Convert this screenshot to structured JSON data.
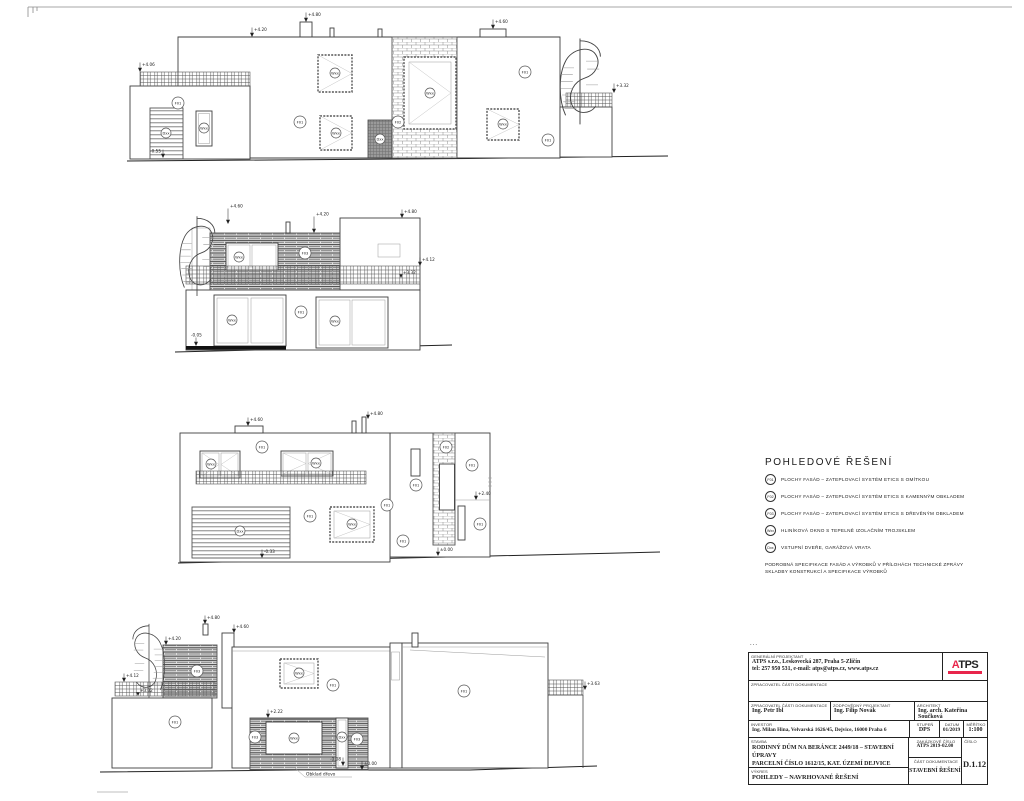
{
  "labels": {
    "f01": "F01",
    "f02": "F02",
    "f03": "F03",
    "w": "Wxx",
    "d": "Dxx"
  },
  "marks": {
    "e1": {
      "p406": "+4.06",
      "p420": "+4.20",
      "p480": "+4.80",
      "p460": "+4.60",
      "p332": "+3.32",
      "n055": "-0.55"
    },
    "e2": {
      "p460": "+4.60",
      "p420": "+4.20",
      "p480": "+4.80",
      "p412": "+4.12",
      "p332": "+3.32",
      "n005": "-0.05"
    },
    "e3": {
      "p460": "+4.60",
      "p480": "+4.80",
      "n033": "-0.33",
      "p240": "+2.40",
      "z000": "±0.00"
    },
    "e4": {
      "p412": "+4.12",
      "p332": "+3.32",
      "p420": "+4.20",
      "p480": "+4.80",
      "p460": "+4.60",
      "p222": "+2.22",
      "n008": "-0.08",
      "z000": "±0.00",
      "p363": "+3.63"
    }
  },
  "annotations": {
    "wood_cladding": "Obklad dřevo"
  },
  "legend": {
    "title": "POHLEDOVÉ ŘEŠENÍ",
    "items": [
      {
        "code": "F01",
        "text": "PLOCHY FASÁD – ZATEPLOVACÍ SYSTÉM ETICS S OMÍTKOU"
      },
      {
        "code": "F02",
        "text": "PLOCHY FASÁD – ZATEPLOVACÍ SYSTÉM ETICS S KAMENNÝM OBKLADEM"
      },
      {
        "code": "F03",
        "text": "PLOCHY FASÁD – ZATEPLOVACÍ SYSTÉM ETICS S DŘEVĚNÝM OBKLADEM"
      },
      {
        "code": "Wxx",
        "text": "HLINÍKOVÁ OKNO S TEPELNĚ IZOLAČNÍM TROJSKLEM"
      },
      {
        "code": "Dxx",
        "text": "VSTUPNÍ DVEŘE, GARÁŽOVÁ VRATA"
      }
    ],
    "note1": "PODROBNÁ SPECIFIKACE FASÁD A VÝROBKŮ V PŘÍLOHÁCH TECHNICKÉ ZPRÁVY",
    "note2": "SKLADBY KONSTRUKCÍ A SPECIFIKACE VÝROBKŮ"
  },
  "titleblock": {
    "dots": "...",
    "general_label": "GENERÁLNÍ PROJEKTANT",
    "company_line1": "ATPS s.r.o., Leskovecká 287, Praha 5-Zličín",
    "company_line2": "tel: 257 950 531, e-mail: atps@atps.cz, www.atps.cz",
    "logo_first_letter": "A",
    "logo_rest": "TPS",
    "processor_label": "ZPRACOVATEL ČÁSTI DOKUMENTACE",
    "processor_name": "Ing. Petr Ibl",
    "responsible_label": "ZODPOVĚDNÝ PROJEKTANT",
    "responsible_name": "Ing. Filip Novák",
    "architect_label": "ARCHITEKT",
    "architect_name": "Ing. arch. Kateřina Součková",
    "investor_label": "INVESTOR",
    "investor_name": "Ing. Milan Hina, Velvarská 1626/45, Dejvice, 16000 Praha 6",
    "stupen_label": "STUPEŇ",
    "stupen": "DPS",
    "datum_label": "DATUM",
    "datum": "01/2019",
    "meritko_label": "MĚŘÍTKO",
    "meritko": "1:100",
    "stavba_label": "STAVBA",
    "stavba_line1": "RODINNÝ DŮM NA BERÁNCE 2449/18 – STAVEBNÍ ÚPRAVY",
    "stavba_line2": "PARCELNÍ ČÍSLO 1612/15, KAT. ÚZEMÍ DEJVICE",
    "zakazka_label": "ZAKÁZKOVÉ ČÍSLO",
    "zakazka": "ATPS 2019-02.00",
    "cislo_label": "ČÍSLO",
    "cislo": "D.1.12",
    "vykres_label": "VÝKRES",
    "vykres": "POHLEDY – NAVRHOVANÉ ŘEŠENÍ",
    "cast_label": "ČÁST DOKUMENTACE",
    "cast": "STAVEBNÍ ŘEŠENÍ"
  }
}
